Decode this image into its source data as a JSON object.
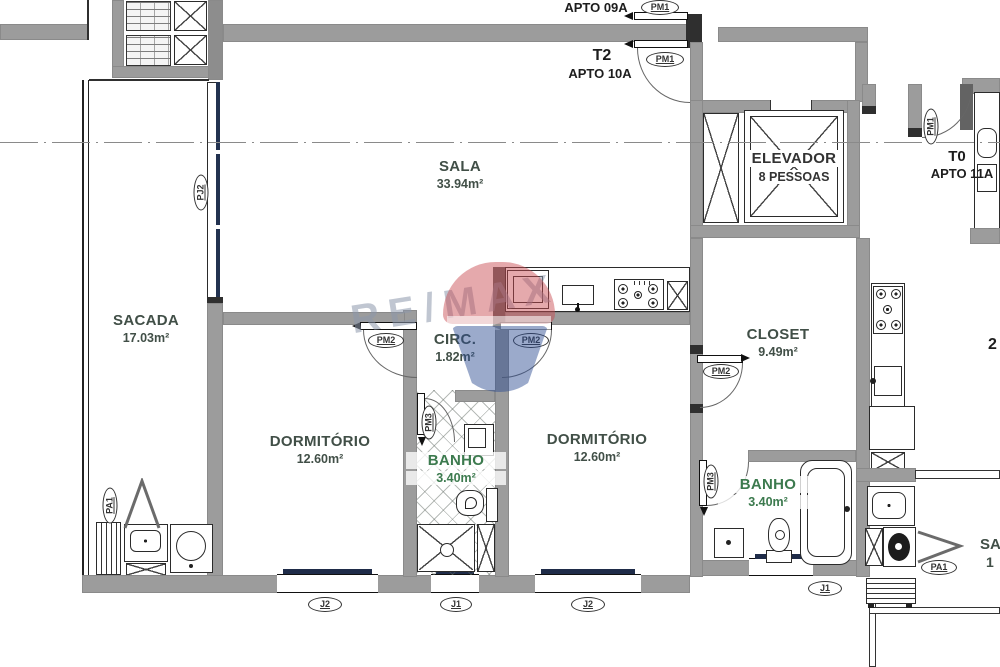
{
  "units": {
    "apto09a": {
      "label": "APTO 09A"
    },
    "apto10a": {
      "type": "T2",
      "label": "APTO 10A"
    },
    "apto11a": {
      "type": "T0",
      "label": "APTO 11A"
    }
  },
  "rooms": {
    "sala": {
      "name": "SALA",
      "area": "33.94m²"
    },
    "sacada": {
      "name": "SACADA",
      "area": "17.03m²"
    },
    "circ": {
      "name": "CIRC.",
      "area": "1.82m²"
    },
    "closet": {
      "name": "CLOSET",
      "area": "9.49m²"
    },
    "dormitorio1": {
      "name": "DORMITÓRIO",
      "area": "12.60m²"
    },
    "dormitorio2": {
      "name": "DORMITÓRIO",
      "area": "12.60m²"
    },
    "banho1": {
      "name": "BANHO",
      "area": "3.40m²"
    },
    "banho2": {
      "name": "BANHO",
      "area": "3.40m²"
    },
    "elevador": {
      "name": "ELEVADOR",
      "capacity": "8 PESSOAS"
    }
  },
  "door_tags": {
    "pm1a": "PM1",
    "pm1b": "PM1",
    "pm1c": "PM1",
    "pj2": "PJ2",
    "pm2a": "PM2",
    "pm2b": "PM2",
    "pm2c": "PM2",
    "pm3a": "PM3",
    "pm3b": "PM3",
    "pa1a": "PA1",
    "pa1b": "PA1"
  },
  "window_tags": {
    "j2a": "J2",
    "j1a": "J1",
    "j2b": "J2",
    "j1b": "J1"
  },
  "cropped_text": {
    "right_mid": "2",
    "right_bottom_line1": "SA",
    "right_bottom_line2": "1"
  },
  "watermark": {
    "brand": "RE/MAX"
  },
  "colors": {
    "wall": "#9c9c9c",
    "glass": "#223250",
    "label": "#414f47",
    "banho_label": "#3c7a4e",
    "watermark_red": "#c84b52",
    "watermark_blue": "#2d4e92"
  }
}
